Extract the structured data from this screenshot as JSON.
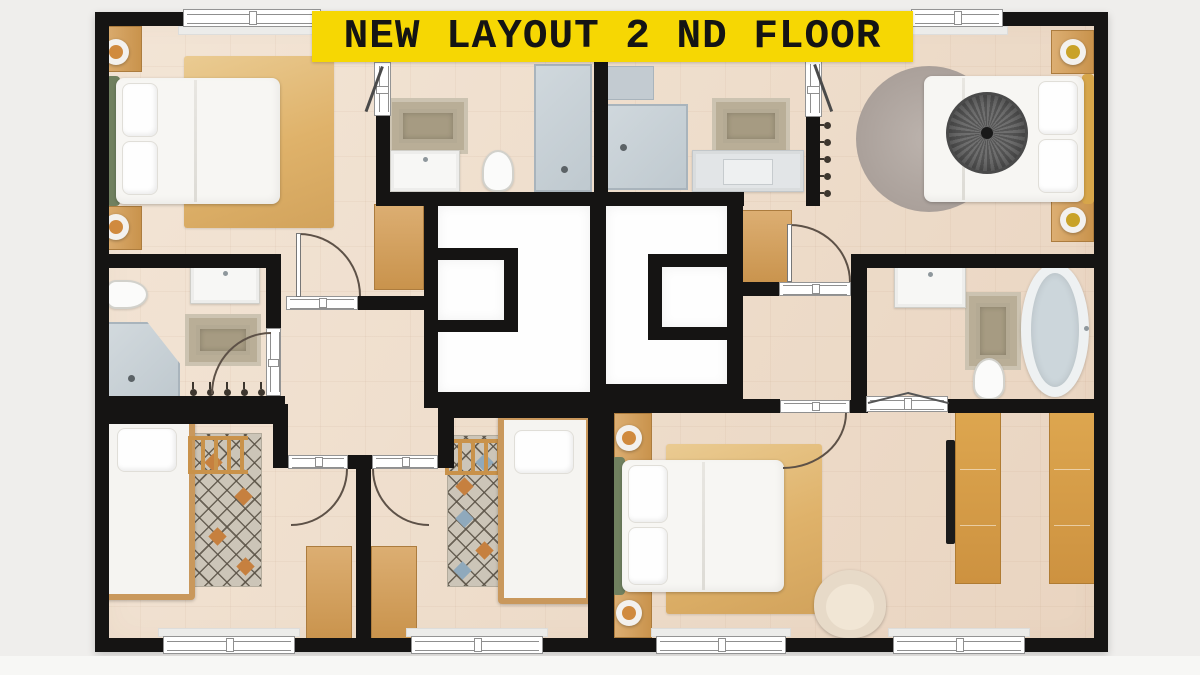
{
  "banner": {
    "title": "NEW LAYOUT 2 ND FLOOR",
    "bg": "#f6d703",
    "fg": "#141414"
  },
  "plan": {
    "wall_color": "#151413",
    "floor_color": "#eeddcb",
    "stairwell_void_color": "#fefefe",
    "background_color": "#efeeec",
    "wood_color": "#d2a05c",
    "green_headboard_color": "#70805f",
    "gold_headboard_color": "#d7a64a",
    "rug_tan_color": "#dfb26a",
    "rug_round_color": "#a99f99",
    "fixture_gray_color": "#c6cfd5",
    "rooms": [
      {
        "name": "bedroom-top-left",
        "furniture": [
          "double-bed-green-headboard",
          "nightstand-with-lamp",
          "nightstand-with-lamp",
          "tan-area-rug",
          "window",
          "door-to-hall",
          "door-to-ensuite"
        ]
      },
      {
        "name": "bathroom-top-left",
        "furniture": [
          "walk-in-shower",
          "toilet",
          "sink-vanity",
          "bath-mat"
        ]
      },
      {
        "name": "bathroom-top-right",
        "furniture": [
          "walk-in-shower",
          "shower-shelf",
          "sink-vanity",
          "bath-mat",
          "towel-hooks",
          "door-to-bedroom"
        ]
      },
      {
        "name": "bedroom-top-right",
        "furniture": [
          "double-bed-gold-headboard",
          "round-throw-blanket",
          "round-rug",
          "nightstand-with-lamp",
          "nightstand-with-lamp",
          "window",
          "door-to-hall"
        ]
      },
      {
        "name": "bathroom-middle-left",
        "furniture": [
          "corner-shower",
          "toilet",
          "sink-vanity",
          "bath-mat",
          "towel-radiator",
          "door"
        ]
      },
      {
        "name": "stairwell-left",
        "furniture": [
          "shaft-closet"
        ]
      },
      {
        "name": "stairwell-right",
        "furniture": [
          "shaft-closet"
        ]
      },
      {
        "name": "hallway",
        "furniture": [
          "cabinet",
          "cabinet"
        ]
      },
      {
        "name": "bathroom-middle-right",
        "furniture": [
          "freestanding-bathtub",
          "toilet",
          "sink-vanity",
          "bath-mat",
          "bifold-door"
        ]
      },
      {
        "name": "bedroom-bottom-left",
        "furniture": [
          "single-bed",
          "diamond-rug",
          "ladder-rack",
          "desk",
          "window",
          "door"
        ]
      },
      {
        "name": "bedroom-bottom-middle",
        "furniture": [
          "single-bed",
          "diamond-rug",
          "ladder-rack",
          "desk",
          "window",
          "door"
        ]
      },
      {
        "name": "bedroom-bottom-right",
        "furniture": [
          "double-bed-green-headboard",
          "nightstand-with-lamp",
          "nightstand-with-lamp",
          "tan-area-rug",
          "armchair",
          "window",
          "door"
        ]
      },
      {
        "name": "walk-in-closet",
        "furniture": [
          "wardrobe-rail",
          "wardrobe-rail",
          "sliding-door",
          "bifold-door",
          "window"
        ]
      }
    ]
  }
}
